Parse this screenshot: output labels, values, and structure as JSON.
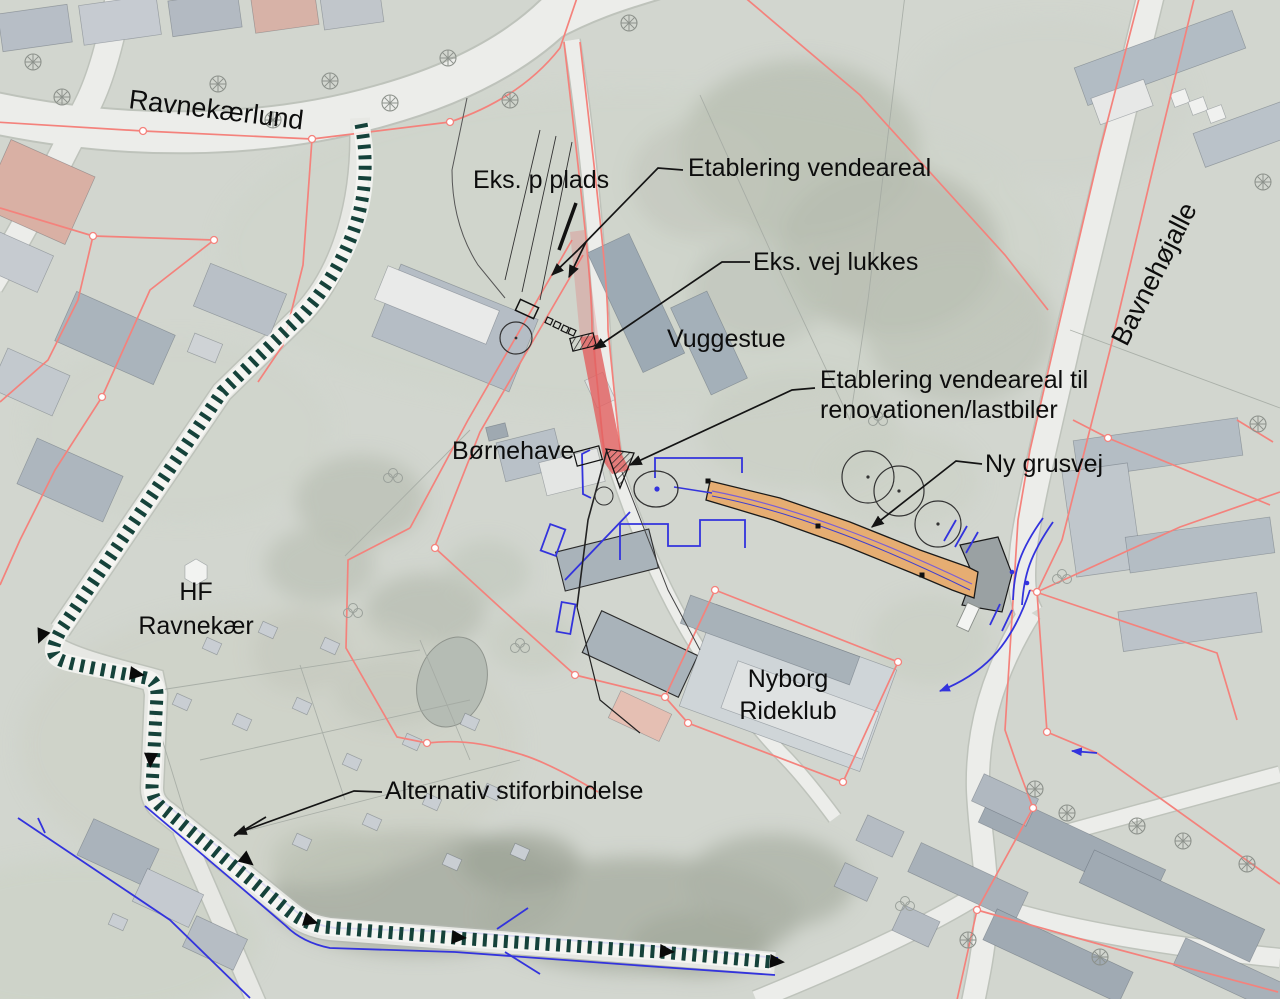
{
  "map": {
    "type": "annotated-aerial-site-plan",
    "street_labels": {
      "ravnekaerlund": "Ravnekærlund",
      "bavnehoejalle": "Bavnehøjalle"
    },
    "place_labels": {
      "vuggestue": "Vuggestue",
      "boernehave": "Børnehave",
      "hf_line1": "HF",
      "hf_line2": "Ravnekær",
      "rideklub_line1": "Nyborg",
      "rideklub_line2": "Rideklub"
    },
    "annotations": {
      "eks_p_plads": "Eks. p plads",
      "etablering_vendeareal": "Etablering vendeareal",
      "eks_vej_lukkes": "Eks. vej lukkes",
      "vendeareal_renovation_line1": "Etablering vendeareal til",
      "vendeareal_renovation_line2": "renovationen/lastbiler",
      "ny_grusvej": "Ny grusvej",
      "alternativ_sti": "Alternativ stiforbindelse"
    },
    "colors": {
      "dashed_path": "#15423a",
      "closed_road_highlight": "#e25f5f",
      "new_gravel_road": "#e6ad72",
      "cadastre_line": "#f4827c",
      "utility_line": "#3333dd",
      "label_text": "#0d0d0d"
    }
  }
}
